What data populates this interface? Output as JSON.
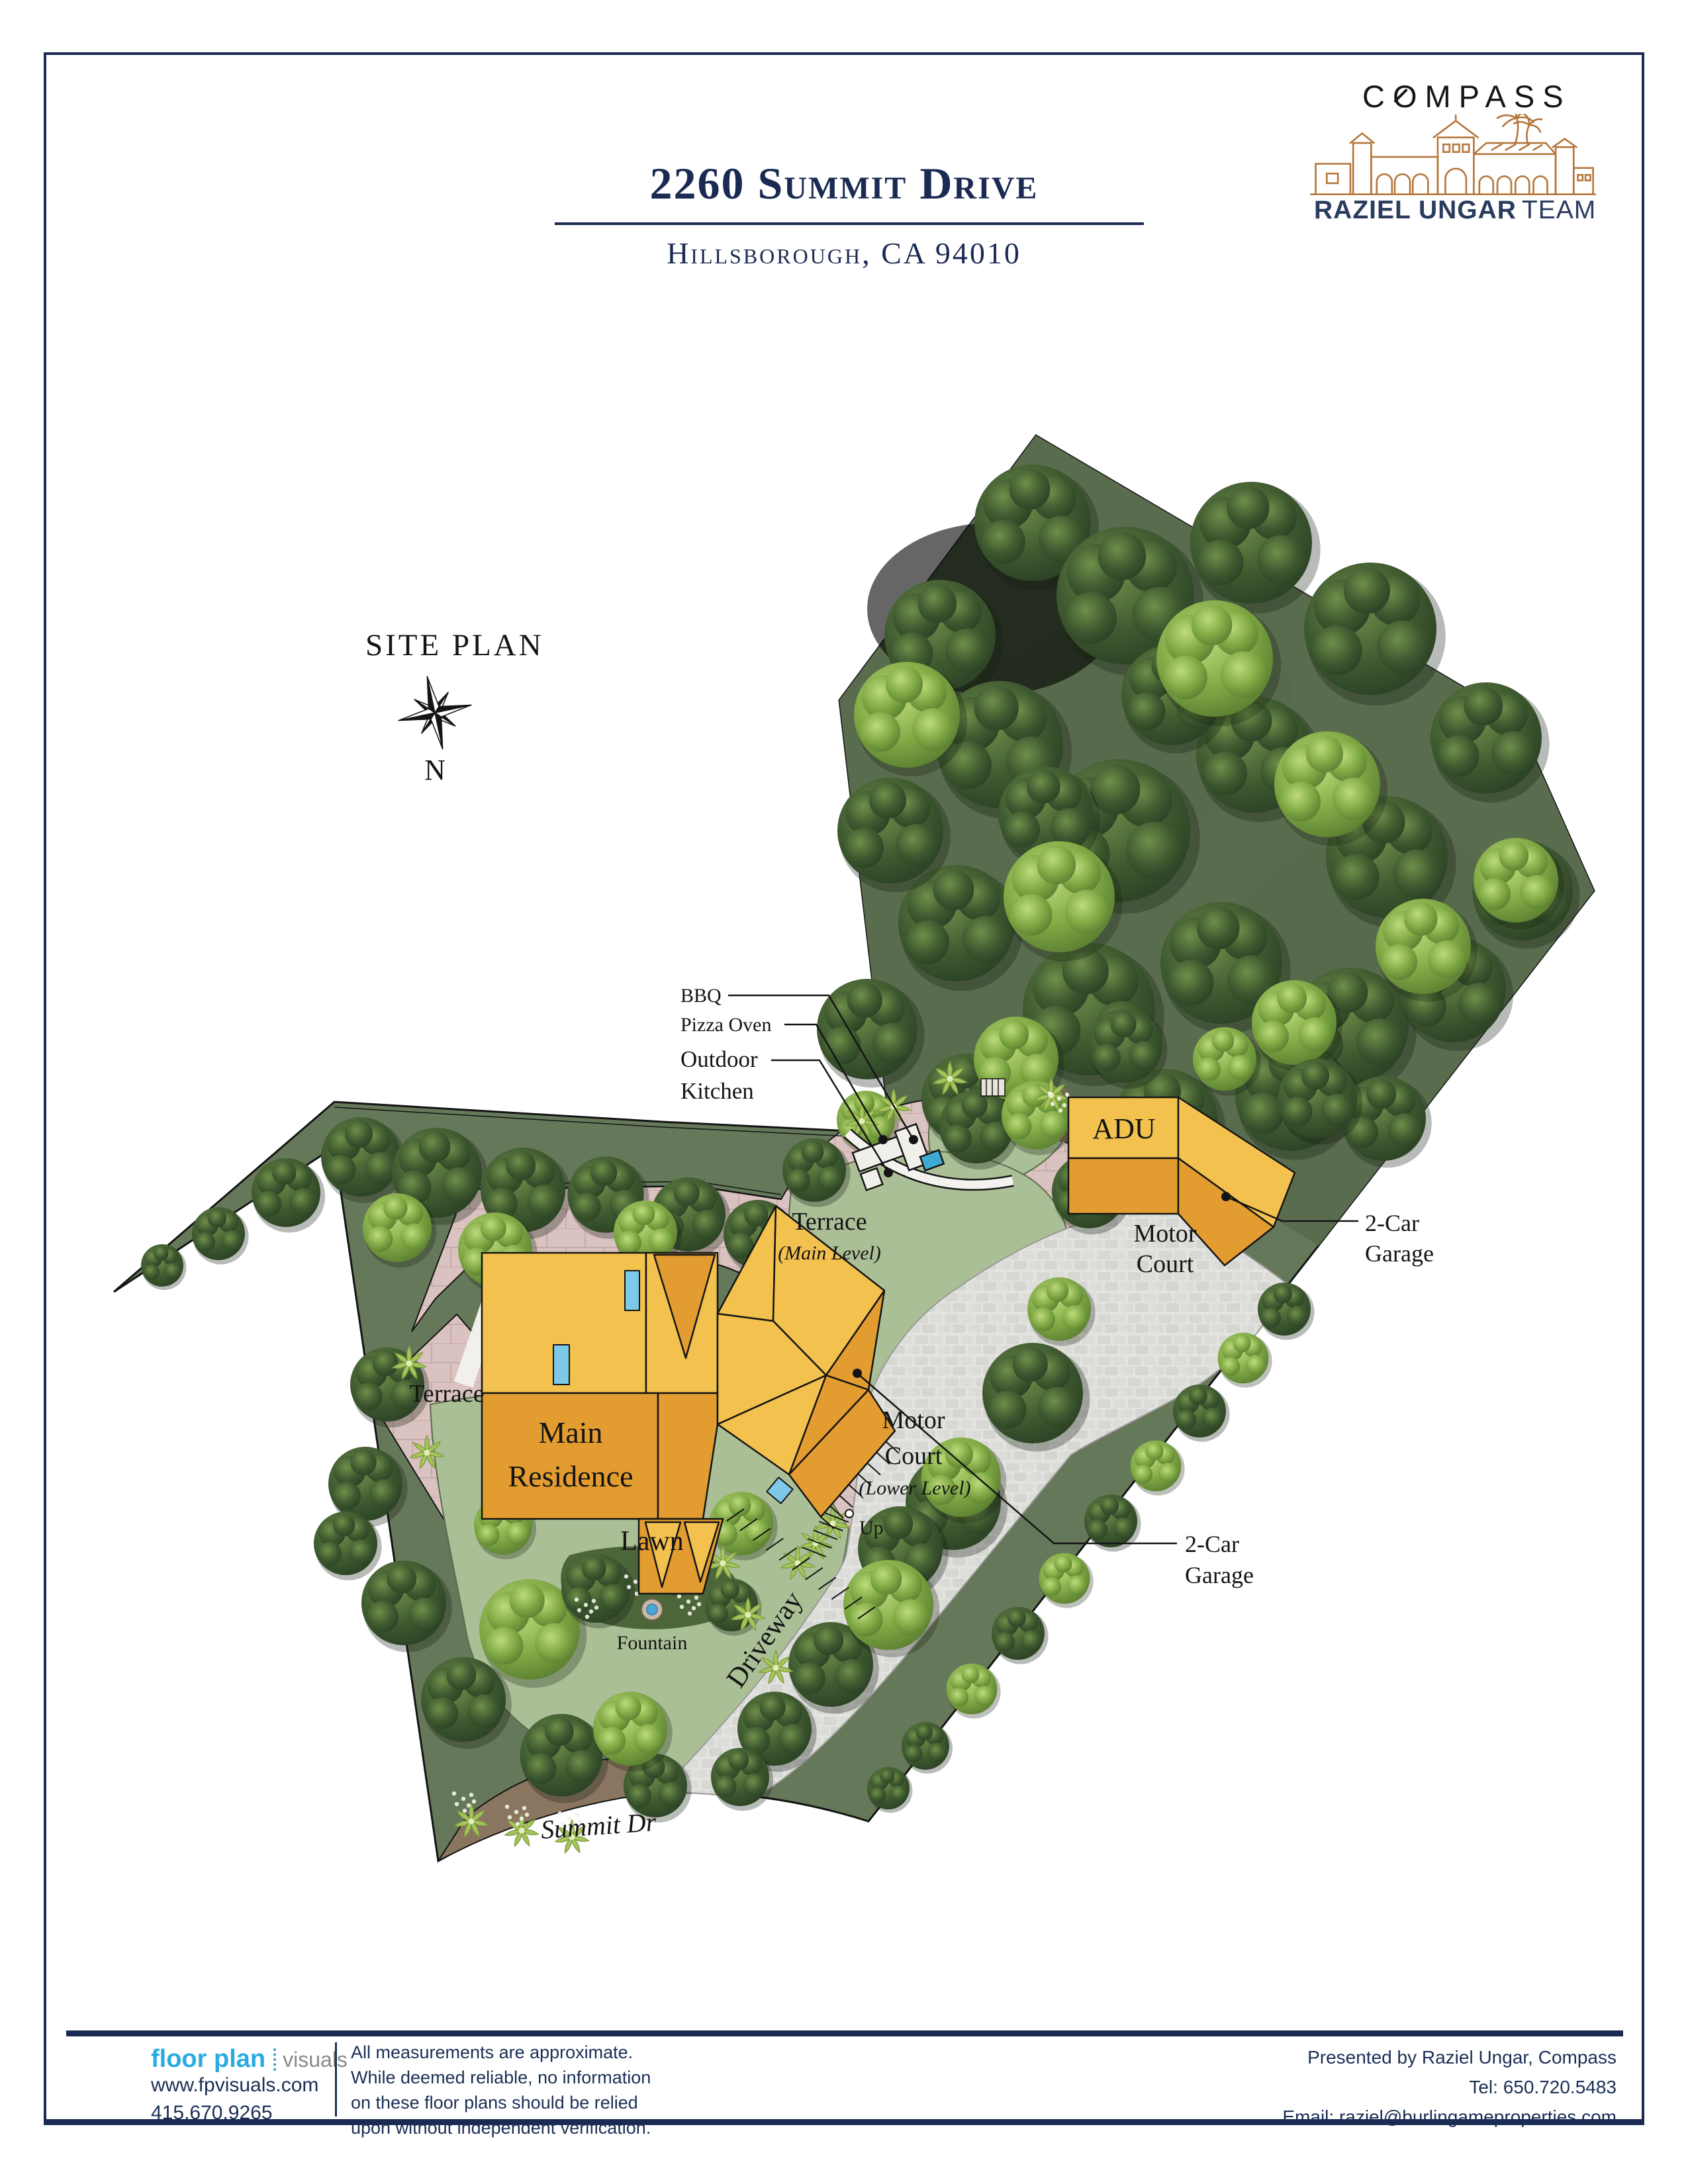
{
  "header": {
    "title": "2260 Summit Drive",
    "subtitle": "Hillsborough, CA 94010"
  },
  "brand": {
    "compass": "COMPASS",
    "team_bold": "RAZIEL UNGAR",
    "team_light": "TEAM"
  },
  "plan": {
    "heading": "SITE PLAN",
    "north": "N",
    "labels": {
      "bbq": "BBQ",
      "pizza_oven": "Pizza Oven",
      "outdoor_kitchen_1": "Outdoor",
      "outdoor_kitchen_2": "Kitchen",
      "terrace_main": "Terrace",
      "terrace_main_sub": "(Main Level)",
      "adu": "ADU",
      "motor_court_1": "Motor",
      "motor_court_2": "Court",
      "garage_adu_1": "2-Car",
      "garage_adu_2": "Garage",
      "terrace_left": "Terrace",
      "residence_1": "Main",
      "residence_2": "Residence",
      "motor_court_lower_1": "Motor",
      "motor_court_lower_2": "Court",
      "motor_court_lower_sub": "(Lower Level)",
      "garage_lower_1": "2-Car",
      "garage_lower_2": "Garage",
      "lawn": "Lawn",
      "fountain": "Fountain",
      "up": "Up",
      "driveway": "Driveway",
      "street": "Summit Dr"
    }
  },
  "footer": {
    "logo_primary": "floor plan",
    "logo_secondary": "visuals",
    "website": "www.fpvisuals.com",
    "phone": "415.670.9265",
    "disclaimer": [
      "All measurements are approximate.",
      "While deemed reliable, no information",
      "on these floor plans should be relied",
      "upon without independent verification."
    ],
    "presented_by": "Presented by Raziel Ungar, Compass",
    "tel": "Tel: 650.720.5483",
    "email": "Email: raziel@burlingameproperties.com"
  },
  "colors": {
    "navy": "#1a2a52",
    "accent_blue": "#29abe2",
    "building_light": "#f2c14e",
    "building_dark": "#e39c2f",
    "terrace_pink": "#d9c2bf",
    "lawn_green": "#abbf97",
    "forest_ground": "#66785a",
    "paving_gray": "#e3e3e0",
    "brand_orange": "#b5763b"
  }
}
